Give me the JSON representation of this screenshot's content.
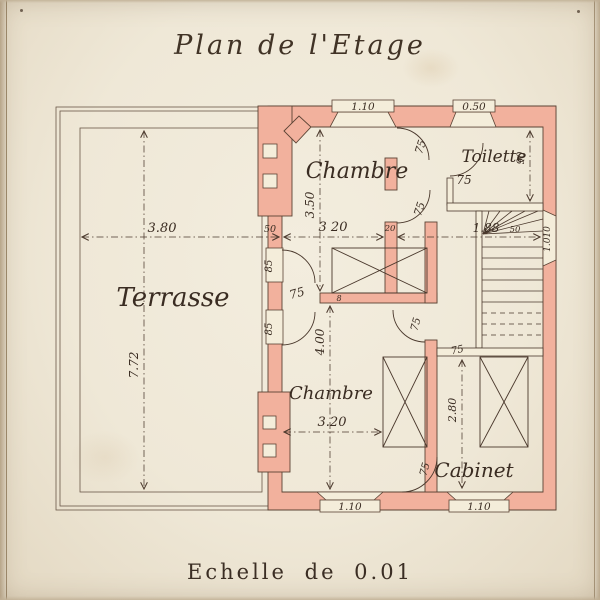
{
  "title": "Plan de l'Etage",
  "scale_caption": "Echelle de 0.01",
  "colors": {
    "paper": "#efe8d7",
    "wall_fill": "#f2b19d",
    "ink": "#4a382c"
  },
  "rooms": {
    "terrasse": "Terrasse",
    "chambre_upper": "Chambre",
    "chambre_lower": "Chambre",
    "toilette": "Toilette",
    "cabinet": "Cabinet"
  },
  "dims": {
    "terrace_width": "3.80",
    "terrace_depth": "7.72",
    "terrace_wall": "50",
    "chambre_upper_width": "3 20",
    "chambre_upper_depth": "3.50",
    "hall_width": "1.88",
    "wall_20": "20",
    "wall_8": "8",
    "right_wall": "50",
    "right_window": "1.010",
    "toilette_width": "75",
    "toilette_depth": "90",
    "chambre_lower_width": "3.20",
    "chambre_lower_depth": "4.00",
    "cabinet_depth": "2.80"
  },
  "doors": {
    "chambre_upper_door1": "75",
    "chambre_upper_door2": "75",
    "vestibule_door": "75",
    "chambre_lower_door": "75",
    "cabinet_door": "75",
    "hall_door": "75",
    "terrace_door1": "85",
    "terrace_door2": "85"
  },
  "windows": {
    "top_left": "1.10",
    "top_right": "0.50",
    "bottom_left": "1.10",
    "bottom_right": "1.10"
  }
}
